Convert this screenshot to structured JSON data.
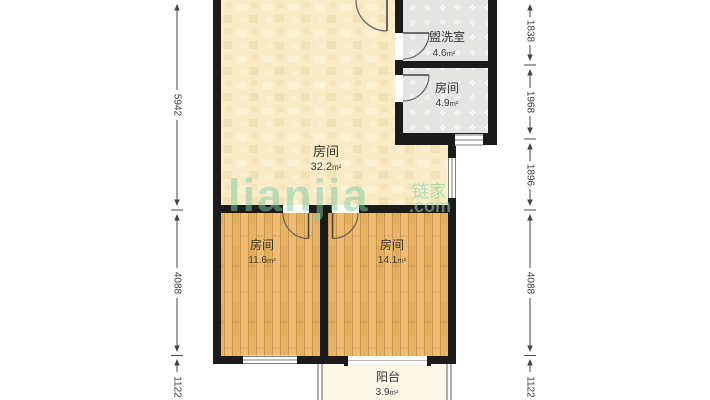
{
  "floorplan": {
    "unit": "m²",
    "rooms": [
      {
        "id": "room-32",
        "name": "房间",
        "area": "32.2"
      },
      {
        "id": "washroom",
        "name": "盥洗室",
        "area": "4.6"
      },
      {
        "id": "room-4-9",
        "name": "房间",
        "area": "4.9"
      },
      {
        "id": "room-11-6",
        "name": "房间",
        "area": "11.6"
      },
      {
        "id": "room-14-1",
        "name": "房间",
        "area": "14.1"
      },
      {
        "id": "balcony",
        "name": "阳台",
        "area": "3.9"
      }
    ],
    "dimensions_left": [
      "5942",
      "4088",
      "1122"
    ],
    "dimensions_right": [
      "1838",
      "1968",
      "1896",
      "4088",
      "1122"
    ],
    "watermark": {
      "logo": "lianjia",
      "brand_cn": "链家",
      "suffix": ".com"
    },
    "colors": {
      "wall": "#1b1b1b",
      "floor_cream": "#f8ebc6",
      "floor_wood": "#e8b365",
      "floor_tile": "#e4e4e2",
      "floor_balcony": "#fbf7e6",
      "watermark_green": "#7ecfa4"
    }
  }
}
